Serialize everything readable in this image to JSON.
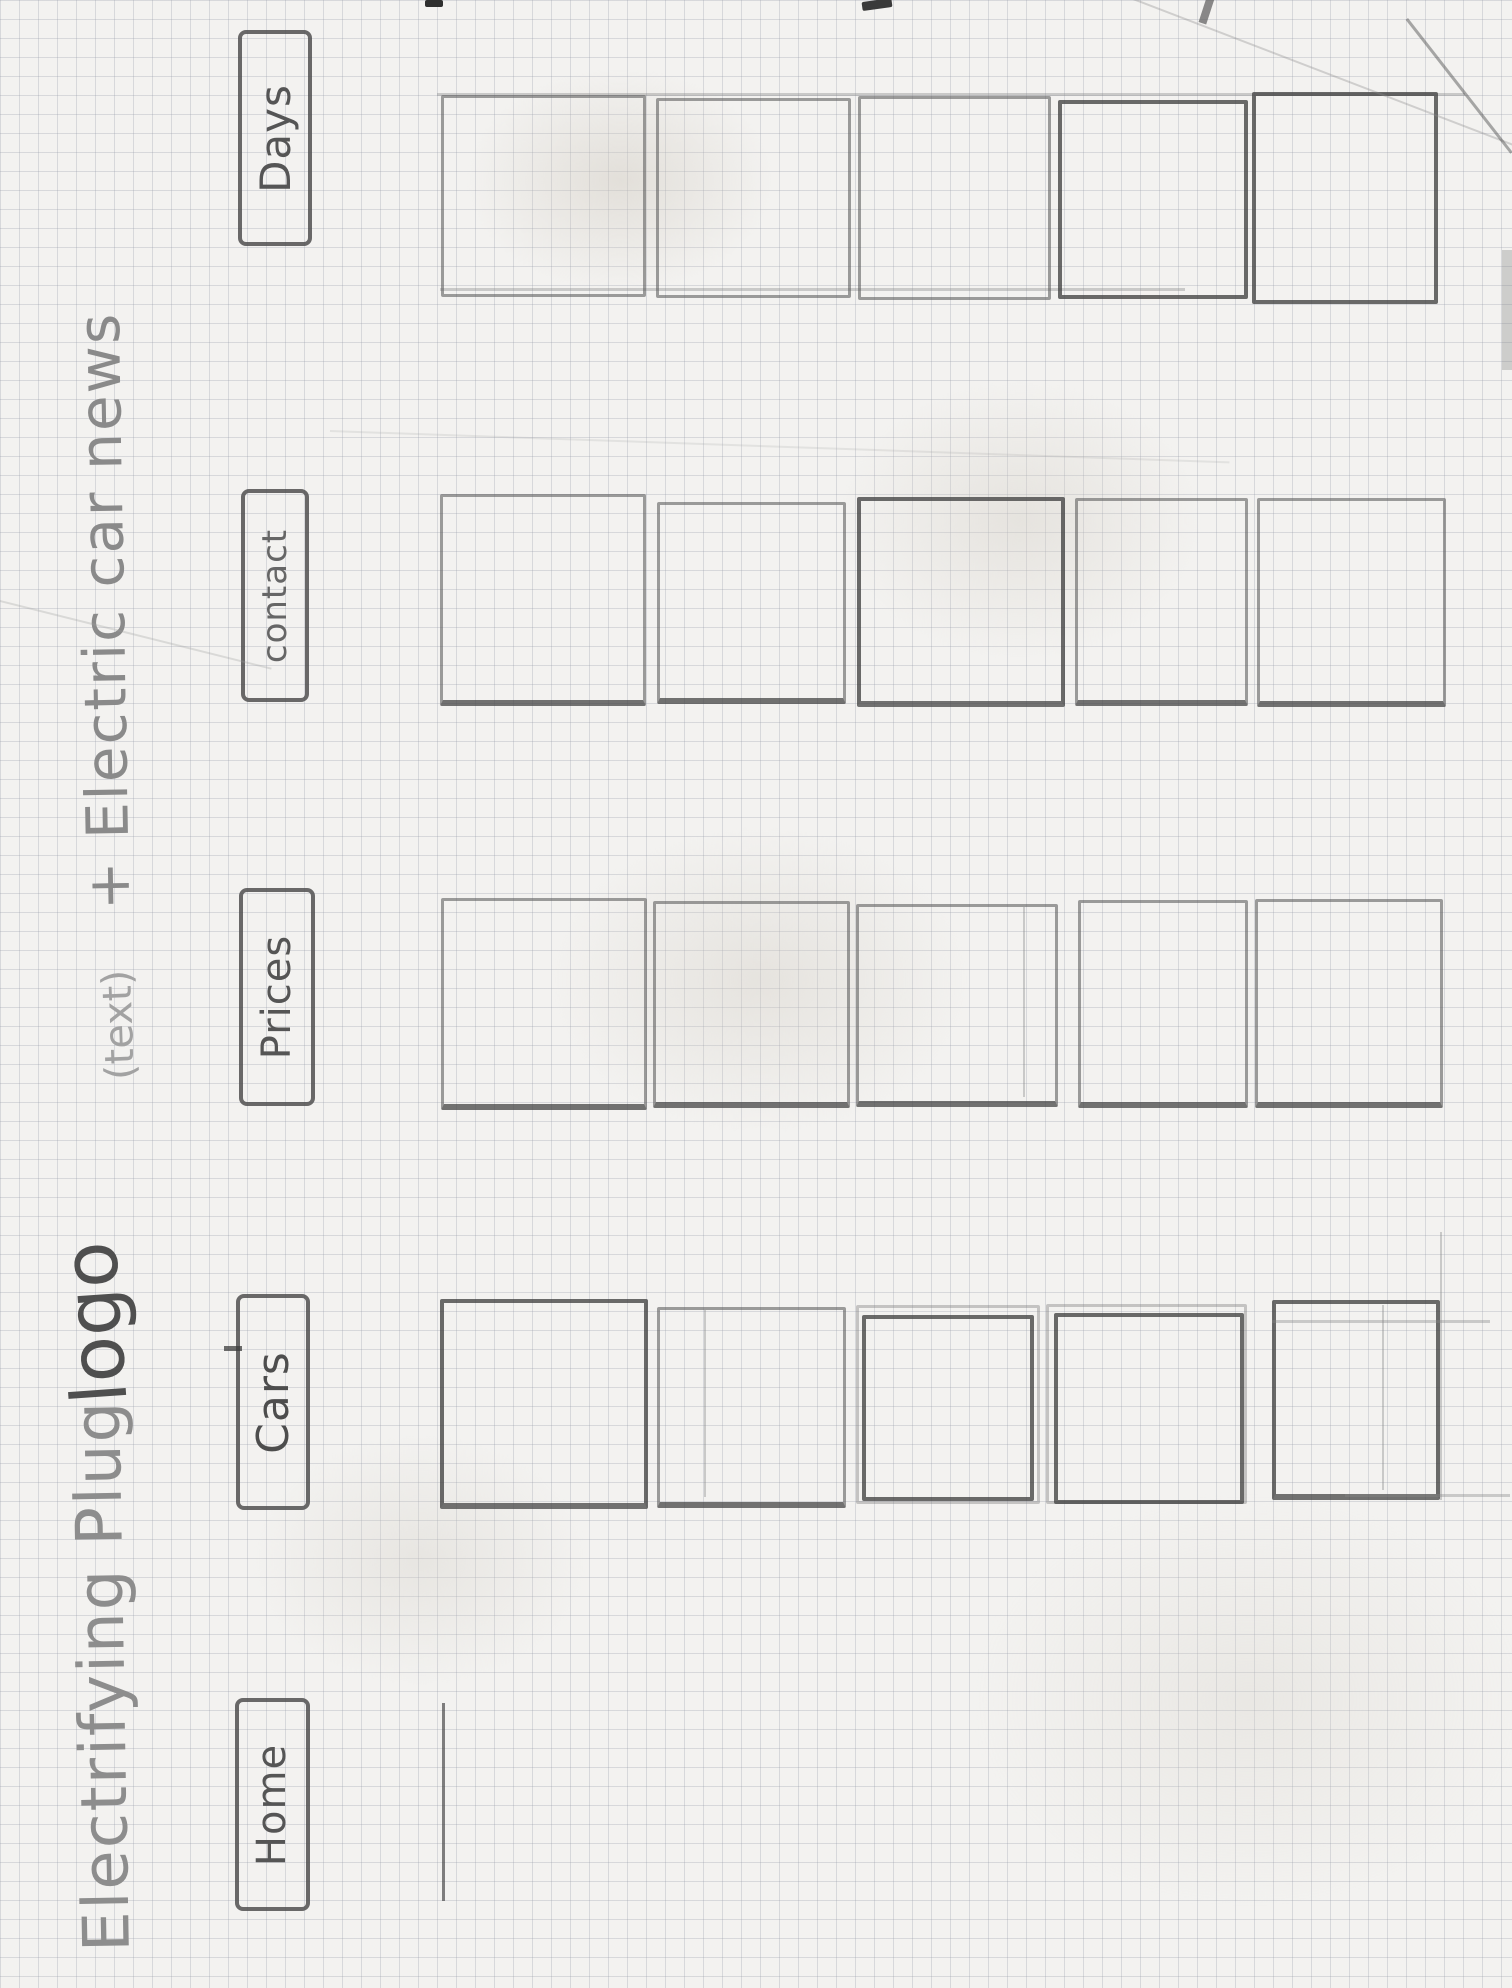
{
  "page": {
    "paper_color": "#f3f2f0",
    "grid_line_color": "#969ba8",
    "pencil_color": "#5f5f5f"
  },
  "title": {
    "main": "Electrifying Plug",
    "logo_annotation": "logo",
    "text_annotation": "(text)",
    "suffix": "+ Electric car news"
  },
  "nav": {
    "items": [
      {
        "label": "Days"
      },
      {
        "label": "contact"
      },
      {
        "label": "Prices"
      },
      {
        "label": "Cars"
      },
      {
        "label": "Home"
      }
    ]
  },
  "content": {
    "rows": [
      {
        "section": "Days",
        "box_count": 5
      },
      {
        "section": "contact",
        "box_count": 5
      },
      {
        "section": "Prices",
        "box_count": 5
      },
      {
        "section": "Cars",
        "box_count": 5
      },
      {
        "section": "Home",
        "box_count": 0,
        "note": "single started line only"
      }
    ]
  }
}
